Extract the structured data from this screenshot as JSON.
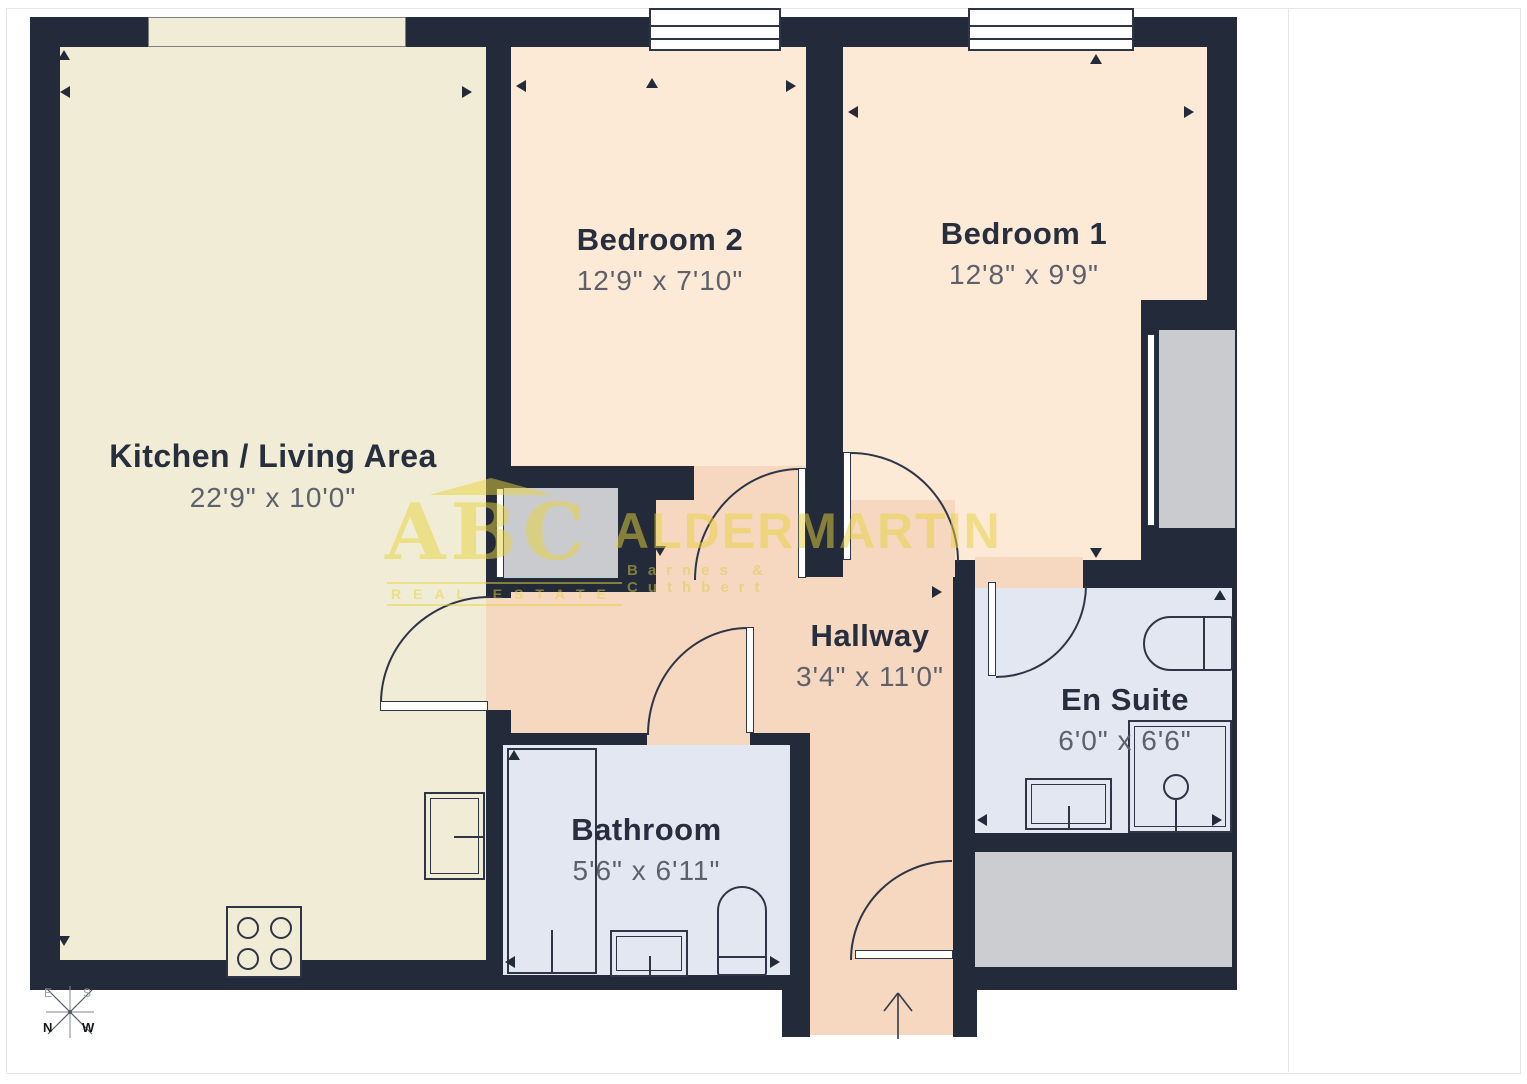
{
  "plan": {
    "rooms": [
      {
        "name": "Kitchen / Living Area",
        "dims": "22'9\" x 10'0\""
      },
      {
        "name": "Bedroom 2",
        "dims": "12'9\" x 7'10\""
      },
      {
        "name": "Bedroom 1",
        "dims": "12'8\" x 9'9\""
      },
      {
        "name": "Hallway",
        "dims": "3'4\" x 11'0\""
      },
      {
        "name": "En Suite",
        "dims": "6'0\" x 6'6\""
      },
      {
        "name": "Bathroom",
        "dims": "5'6\" x 6'11\""
      }
    ],
    "compass": {
      "north": "N",
      "east": "E",
      "south": "S",
      "west": "W"
    },
    "watermark": {
      "abc": "ABC",
      "tagline": "REAL ESTATE",
      "name": "ALDERMARTIN",
      "subtitle": "Barnes & Cuthbert"
    }
  },
  "sidebar": {
    "logo": {
      "abc": "ABC",
      "tagline": "REAL ESTATE",
      "name": "ALDERMARTIN",
      "subtitle": "Barnes & Cuthbert"
    },
    "area": {
      "title": "Approximate total area",
      "footnote_marker": "(1)",
      "value": "615 ft²"
    },
    "footnote": "(1) Excluding balconies and terraces",
    "disclaimer": "Calculations reference the RICS IPMS 3C standard. Measurements are approximate and not to scale. This floor plan is intended for illustration only.",
    "brand": {
      "name": "GIRAFFE",
      "suffix": "360"
    }
  },
  "colors": {
    "wall": "#232a39",
    "kitchen": "#f1ecd6",
    "bedroom": "#fce9d6",
    "hallway": "#f6d7bf",
    "wet_room": "#e3e7f1",
    "closet_gray": "#c9cbce",
    "storage_gray": "#cccdd0",
    "brand_yellow": "#f0c41d",
    "watermark_yellow": "#e7d33c"
  }
}
